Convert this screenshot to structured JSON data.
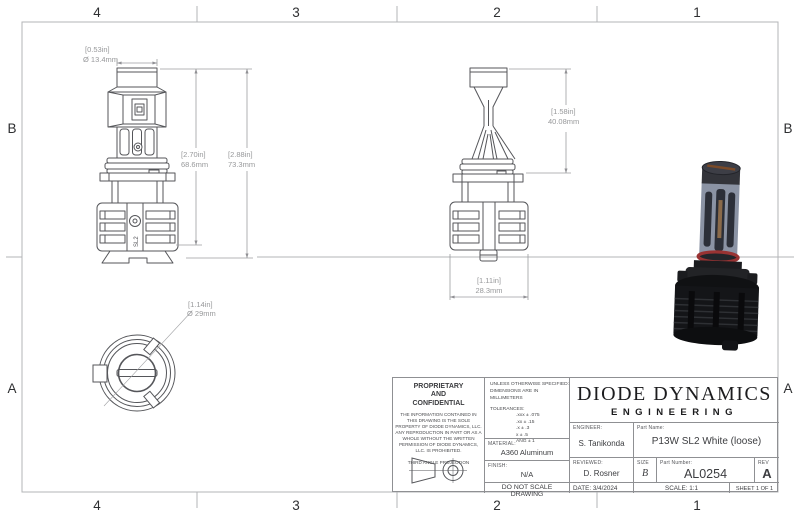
{
  "sheet": {
    "zones_top": [
      "4",
      "3",
      "2",
      "1"
    ],
    "zones_bottom": [
      "4",
      "3",
      "2",
      "1"
    ],
    "zones_left": [
      "B",
      "A"
    ],
    "zones_right": [
      "B",
      "A"
    ]
  },
  "part_marking": "SL2",
  "dimensions": {
    "cap_width": {
      "in": "[0.53in]",
      "mm": "Ø 13.4mm"
    },
    "body_height": {
      "in": "[2.70in]",
      "mm": "68.6mm"
    },
    "overall_height": {
      "in": "[2.88in]",
      "mm": "73.3mm"
    },
    "tip_height": {
      "in": "[1.58in]",
      "mm": "40.08mm"
    },
    "base_width": {
      "in": "[1.11in]",
      "mm": "28.3mm"
    },
    "base_diameter": {
      "in": "[1.14in]",
      "mm": "Ø 29mm"
    }
  },
  "title_block": {
    "proprietary": {
      "heading1": "PROPRIETARY",
      "heading2": "AND",
      "heading3": "CONFIDENTIAL",
      "body": "THE INFORMATION CONTAINED IN THIS DRAWING IS THE SOLE PROPERTY OF DIODE DYNAMICS, LLC.  ANY REPRODUCTION IN PART OR AS A WHOLE WITHOUT THE WRITTEN PERMISSION OF DIODE DYNAMICS, LLC. IS PROHIBITED.",
      "projection_label": "THIRD ANGLE PROJECTION"
    },
    "specs": {
      "unless1": "UNLESS OTHERWISE SPECIFIED:",
      "unless2": "DIMENSIONS ARE IN MILLIMETERS",
      "tol_title": "TOLERANCES:",
      "tol_lines": [
        ".xxx ± .075",
        ".xx ± .15",
        ".x ± .3",
        "x ± .5",
        "ANG ± 1"
      ],
      "material_label": "MATERIAL:",
      "material_value": "A360 Aluminum",
      "finish_label": "FINISH:",
      "finish_value": "N/A",
      "do_not_scale": "DO NOT SCALE DRAWING"
    },
    "company": {
      "name": "DIODE DYNAMICS",
      "division": "ENGINEERING"
    },
    "people": {
      "engineer_label": "ENGINEER:",
      "engineer": "S. Tanikonda",
      "reviewed_label": "REVIEWED:",
      "reviewed": "D. Rosner"
    },
    "part": {
      "name_label": "Part Name:",
      "name": "P13W SL2 White (loose)",
      "size_label": "SIZE",
      "size": "B",
      "number_label": "Part Number:",
      "number": "AL0254",
      "rev_label": "REV",
      "rev": "A"
    },
    "footer": {
      "date_label": "DATE:",
      "date": "3/4/2024",
      "scale": "SCALE: 1:1",
      "sheet": "SHEET 1 OF 1"
    }
  }
}
